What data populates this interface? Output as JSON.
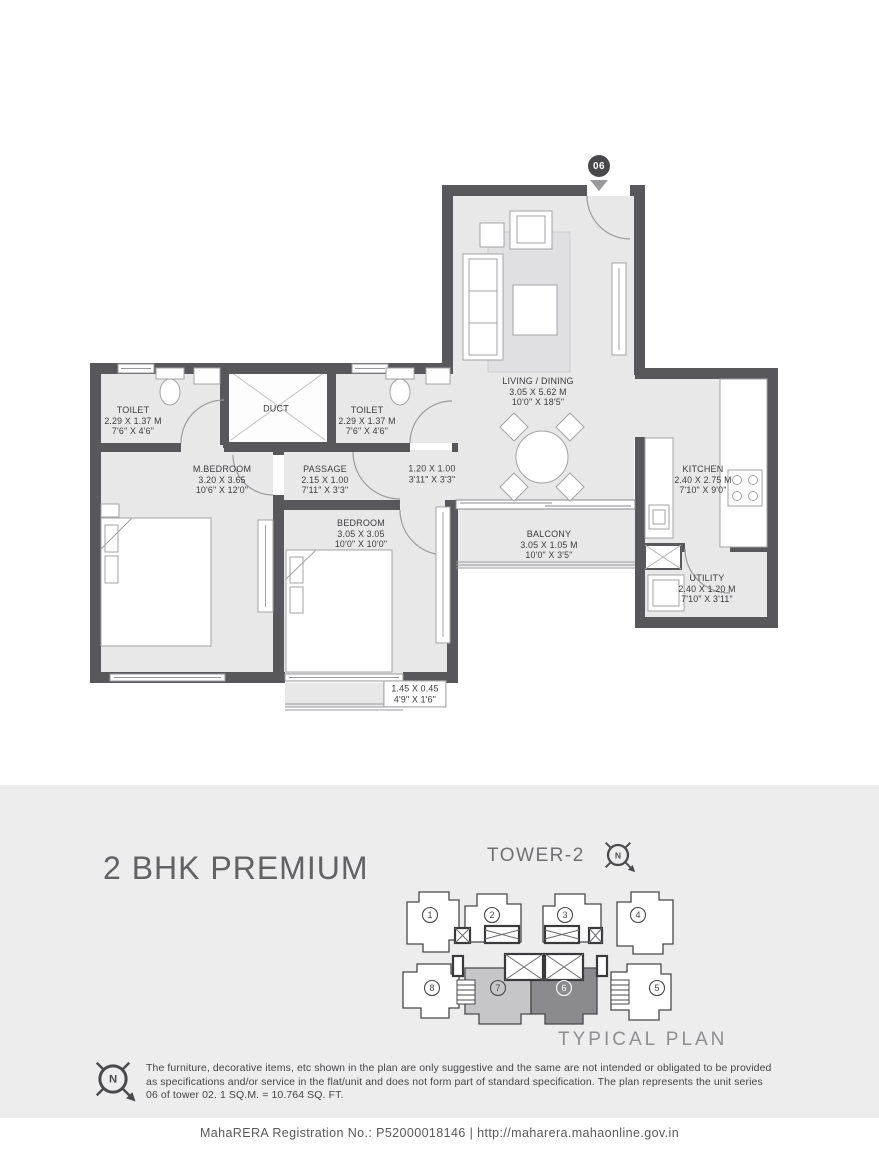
{
  "colors": {
    "wall": "#58585c",
    "floor": "#e8e8e9",
    "band": "#ededee",
    "marker": "#48484b",
    "unit_highlight_dark": "#8b8b8f",
    "unit_highlight_light": "#c6c6c9"
  },
  "plan": {
    "unit_marker": "06",
    "rooms": [
      {
        "id": "toilet-1",
        "name": "TOILET",
        "dims_m": "2.29 X 1.37 M",
        "dims_ft": "7'6\" X 4'6\""
      },
      {
        "id": "duct",
        "name": "DUCT",
        "dims_m": "",
        "dims_ft": ""
      },
      {
        "id": "toilet-2",
        "name": "TOILET",
        "dims_m": "2.29 X 1.37 M",
        "dims_ft": "7'6\" X 4'6\""
      },
      {
        "id": "living-dining",
        "name": "LIVING / DINING",
        "dims_m": "3.05 X 5.62 M",
        "dims_ft": "10'0\" X 18'5\""
      },
      {
        "id": "m-bedroom",
        "name": "M.BEDROOM",
        "dims_m": "3.20 X 3.65",
        "dims_ft": "10'6\" X 12'0\""
      },
      {
        "id": "passage",
        "name": "PASSAGE",
        "dims_m": "2.15 X 1.00",
        "dims_ft": "7'11\" X 3'3\""
      },
      {
        "id": "foyer",
        "name": "",
        "dims_m": "1.20 X 1.00",
        "dims_ft": "3'11\" X 3'3\""
      },
      {
        "id": "kitchen",
        "name": "KITCHEN",
        "dims_m": "2.40 X 2.75 M",
        "dims_ft": "7'10\" X 9'0\""
      },
      {
        "id": "bedroom",
        "name": "BEDROOM",
        "dims_m": "3.05 X 3.05",
        "dims_ft": "10'0\" X 10'0\""
      },
      {
        "id": "balcony",
        "name": "BALCONY",
        "dims_m": "3.05 X 1.05 M",
        "dims_ft": "10'0\" X 3'5\""
      },
      {
        "id": "utility",
        "name": "UTILITY",
        "dims_m": "2.40 X 1.20 M",
        "dims_ft": "7'10\" X 3'11\""
      },
      {
        "id": "deck",
        "name": "",
        "dims_m": "1.45 X 0.45",
        "dims_ft": "4'9\" X 1'6\""
      }
    ]
  },
  "info": {
    "unit_type": "2 BHK PREMIUM",
    "tower": "TOWER-2",
    "plan_type": "TYPICAL PLAN",
    "units_top": [
      "1",
      "2",
      "3",
      "4"
    ],
    "units_bottom": [
      "8",
      "7",
      "6",
      "5"
    ],
    "highlighted_unit": "6",
    "disclaimer_lines": [
      "The furniture, decorative items, etc shown in the plan are only suggestive and the same are not intended or obligated to be provided",
      "as specifications and/or service in the flat/unit and does not form part of standard specification. The plan represents the unit series",
      "06 of tower 02. 1 SQ.M. = 10.764 SQ. FT."
    ]
  },
  "footer": {
    "registration": "MahaRERA Registration No.: P52000018146 | http://maharera.mahaonline.gov.in"
  }
}
